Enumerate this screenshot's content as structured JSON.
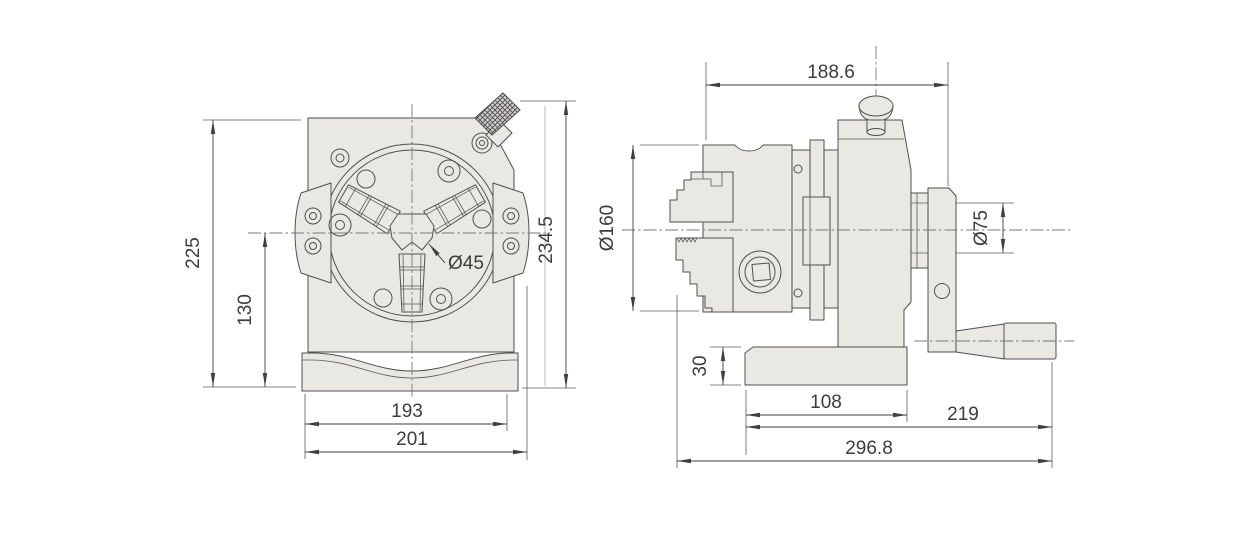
{
  "drawing": {
    "type": "engineering-dimension-drawing",
    "part_fill_color": "#e9e8e3",
    "outline_color": "#4f4f4f",
    "dimension_color": "#3c3c3c",
    "views": {
      "front": {
        "dims": {
          "overall_height": "225",
          "center_height": "130",
          "total_height_with_knob": "234.5",
          "center_bore_dia": "Ø45",
          "body_width": "193",
          "base_width": "201"
        }
      },
      "side": {
        "dims": {
          "body_length": "188.6",
          "chuck_dia": "Ø160",
          "spindle_boss_dia": "Ø75",
          "base_height": "30",
          "base_length": "108",
          "handle_length": "219",
          "overall_length": "296.8"
        }
      }
    }
  }
}
